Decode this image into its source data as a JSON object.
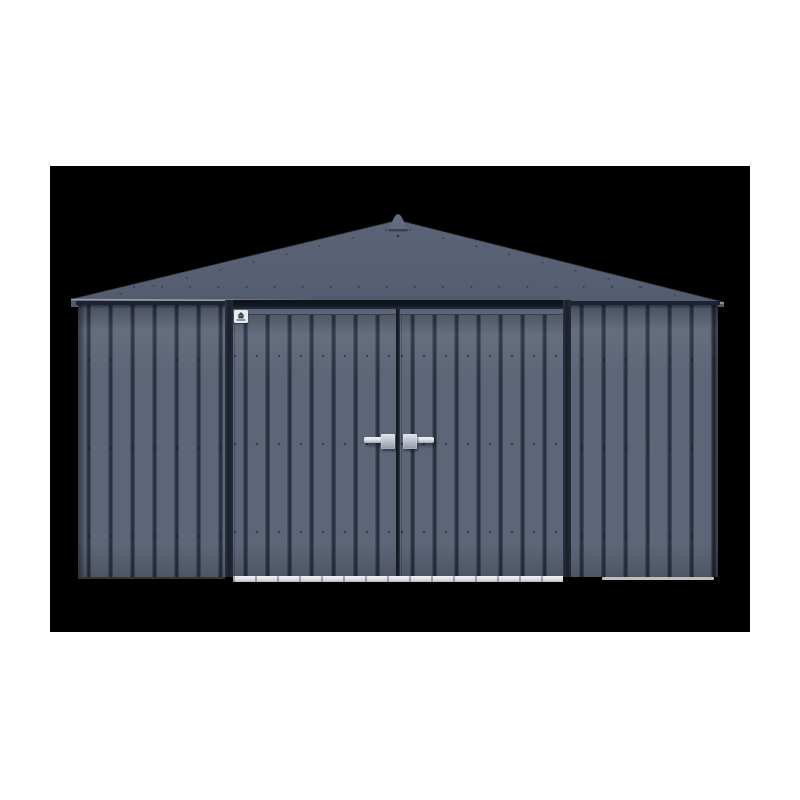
{
  "meta": {
    "alt": "Front view product photo of an anthracite blue-gray vertical-ribbed steel storage shed with a peaked roof, center double doors, two silver lever handles and a small white manufacturer badge, shown on a black rectangle over a white page"
  },
  "colors": {
    "page_bg": "#ffffff",
    "photo_bg": "#000000",
    "wall_flat": "#5d6678",
    "wall_groove": "#262c3a",
    "wall_groove_soft": "#4c5567",
    "wall_groove_edge": "#606979",
    "roof_top": "#5b6476",
    "roof_bottom": "#515a6c",
    "finial": "#626b7d",
    "eave_highlight": "#a9aeb9",
    "rivet": "#343b4b",
    "gap_dark": "#1d2330",
    "trim_dark": "#12161f",
    "frame": "#232936",
    "seam": "#1a1f2a",
    "rail": "#5c6577",
    "badge_bg": "#e9ebee",
    "badge_glyph": "#39414f",
    "handle_plate": "#bfc4cd",
    "handle_plate_hi": "#dfe3e9",
    "handle_plate_lo": "#8e95a2",
    "handle_lever": "#e4e7ec",
    "handle_lever_lo": "#a6adb9",
    "sill": "#dcdee2",
    "ground_line": "#eceef0"
  },
  "shed": {
    "style": "peaked-roof double-door steel shed",
    "door_count": 2,
    "handle_count": 2,
    "rib_pitch_px": 22
  }
}
